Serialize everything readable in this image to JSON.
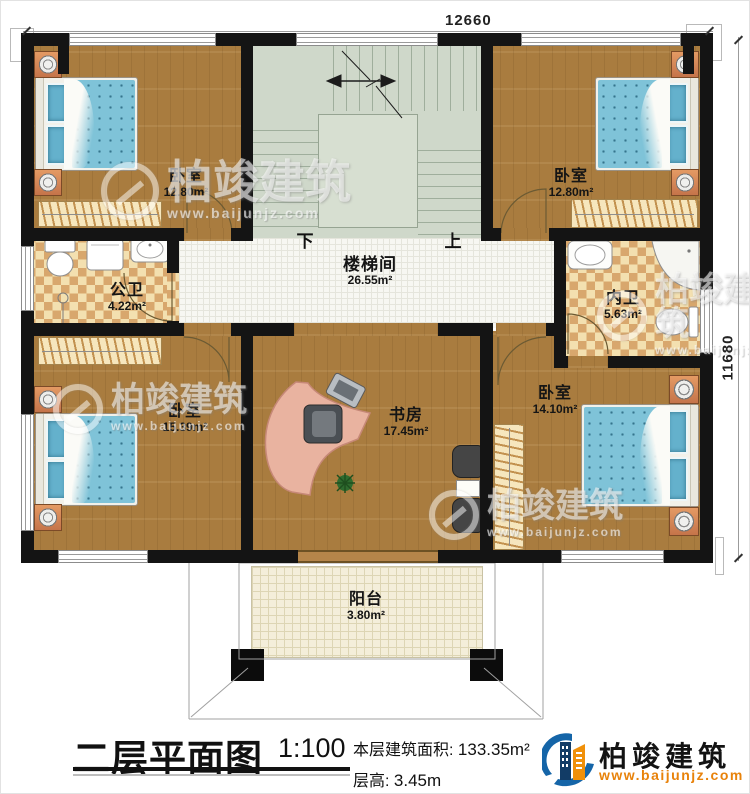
{
  "dims": {
    "top": "12660",
    "right": "11680"
  },
  "stair": {
    "down": "下",
    "up": "上"
  },
  "rooms": {
    "bedroom_tl": {
      "name": "卧室",
      "area": "12.80m²"
    },
    "bedroom_tr": {
      "name": "卧室",
      "area": "12.80m²"
    },
    "public_bath": {
      "name": "公卫",
      "area": "4.22m²"
    },
    "stair_hall": {
      "name": "楼梯间",
      "area": "26.55m²"
    },
    "ensuite_bath": {
      "name": "内卫",
      "area": "5.63m²"
    },
    "bedroom_bl": {
      "name": "卧室",
      "area": "15.39m²"
    },
    "study": {
      "name": "书房",
      "area": "17.45m²"
    },
    "bedroom_br": {
      "name": "卧室",
      "area": "14.10m²"
    },
    "balcony": {
      "name": "阳台",
      "area": "3.80m²"
    }
  },
  "footer": {
    "title": "二层平面图",
    "scale": "1:100",
    "area_label": "本层建筑面积:",
    "area_value": "133.35m²",
    "floor_height_label": "层高:",
    "floor_height_value": "3.45m"
  },
  "brand": {
    "name": "柏竣建筑",
    "website": "www.baijunjz.com"
  },
  "watermark": {
    "text": "柏竣建筑",
    "site": "www.baijunjz.com"
  },
  "colors": {
    "wall": "#141414",
    "wood": "#a97c3f",
    "bed_blue": "#7fc3d8",
    "stair_green": "#cfd8ca",
    "tile_light": "#f3e0b0",
    "tile_dark": "#d8a76d",
    "logo_blue": "#1565a8",
    "logo_orange": "#f0900a"
  }
}
